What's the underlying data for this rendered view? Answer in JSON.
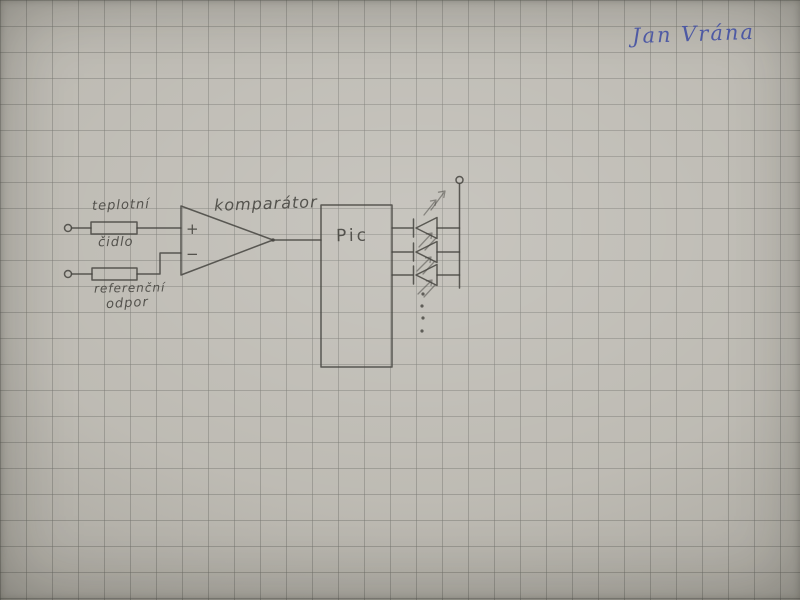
{
  "colors": {
    "paper": "#bab7af",
    "grid-line": "#9d9b93",
    "pencil": "#45443f",
    "ink-blue": "#4653a4"
  },
  "signature": {
    "name": "Jan Vrána"
  },
  "circuit": {
    "temperature_sensor": {
      "line1": "teplotní",
      "line2": "čidlo"
    },
    "reference_resistor": {
      "line1": "referenční",
      "line2": "odpor"
    },
    "comparator": {
      "label": "komparátor",
      "plus": "+",
      "minus": "−"
    },
    "mcu": {
      "label": "Pic"
    }
  }
}
